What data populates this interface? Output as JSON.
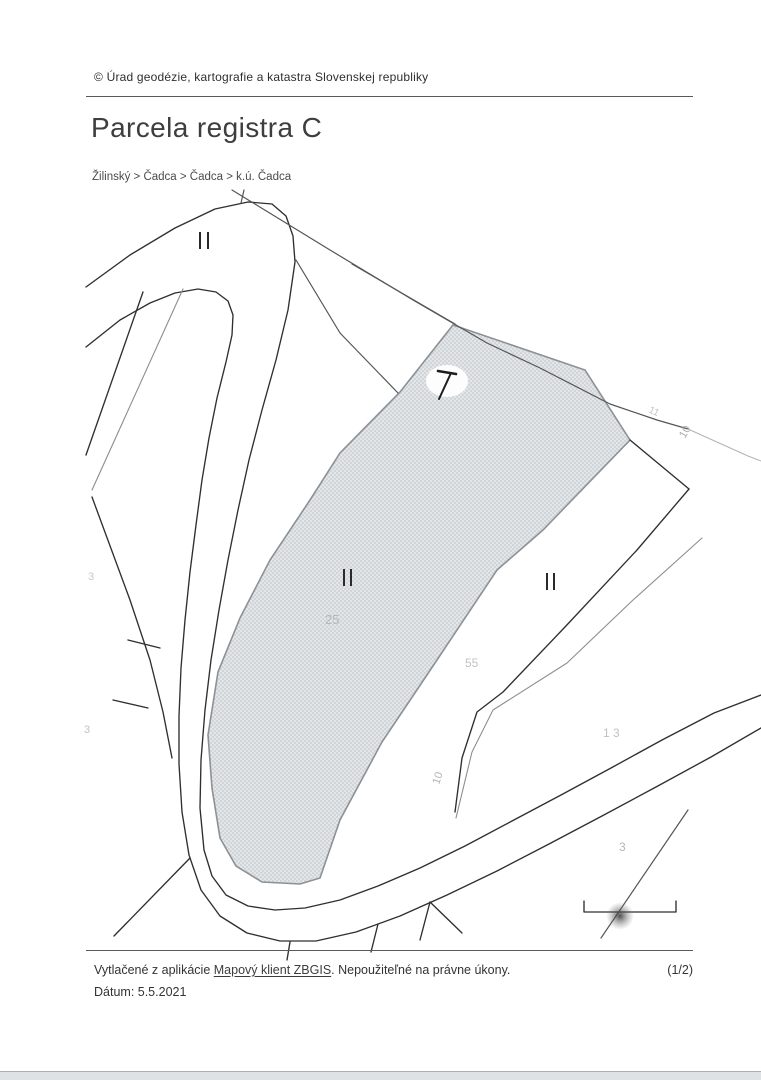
{
  "header": {
    "copyright": "© Úrad geodézie, kartografie a katastra Slovenskej republiky",
    "title": "Parcela registra C",
    "breadcrumb": "Žilinský > Čadca > Čadca > k.ú. Čadca"
  },
  "map": {
    "highlight_fill": "#e3e6e8",
    "highlight_dot": "#ccd0d3",
    "parcel_stroke": "#8b9196",
    "labels": [
      {
        "text": "25"
      },
      {
        "text": "55"
      },
      {
        "text": "1 3"
      },
      {
        "text": "3"
      },
      {
        "text": "10"
      },
      {
        "text": "10"
      },
      {
        "text": "3"
      },
      {
        "text": "11"
      },
      {
        "text": "3"
      }
    ]
  },
  "footer": {
    "printed_prefix": "Vytlačené z aplikácie ",
    "app_link": "Mapový klient ZBGIS",
    "printed_suffix": ". Nepoužiteľné na právne úkony.",
    "page_indicator": "(1/2)",
    "date": "Dátum: 5.5.2021"
  }
}
